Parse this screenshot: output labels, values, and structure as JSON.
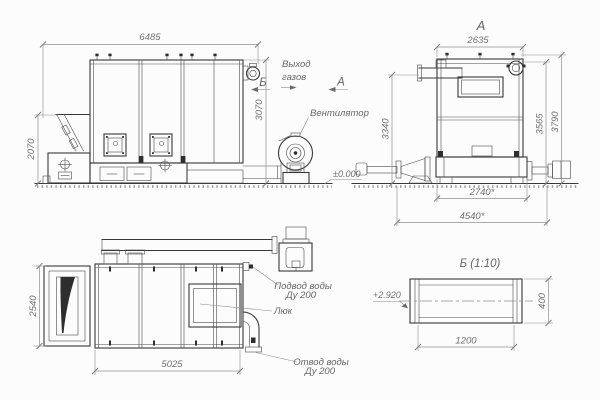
{
  "colors": {
    "background": "#fcfcfc",
    "geometry_line": "#383838",
    "dimension_line": "#909090",
    "text": "#707070"
  },
  "side": {
    "dim_width": "6485",
    "dim_height": "3070",
    "dim_hopper": "2070",
    "gas_line1": "Выход",
    "gas_line2": "газов",
    "marker_b": "Б",
    "marker_a": "А",
    "fan_label": "Вентилятор",
    "elevation": "±0.000"
  },
  "viewA": {
    "title": "А",
    "dim_top": "2635",
    "dim_left": "3340",
    "dim_right_inner": "3565",
    "dim_right_outer": "3790",
    "dim_bottom_inner": "2740*",
    "dim_bottom_outer": "4540*"
  },
  "plan": {
    "dim_left": "2540",
    "dim_bottom": "5025",
    "supply_line1": "Подвод воды",
    "supply_line2": "Ду 200",
    "hatch_label": "Люк",
    "drain_line1": "Отвод воды",
    "drain_line2": "Ду 200"
  },
  "viewB": {
    "title": "Б (1:10)",
    "elevation": "+2.920",
    "dim_height": "400",
    "dim_width": "1200"
  }
}
